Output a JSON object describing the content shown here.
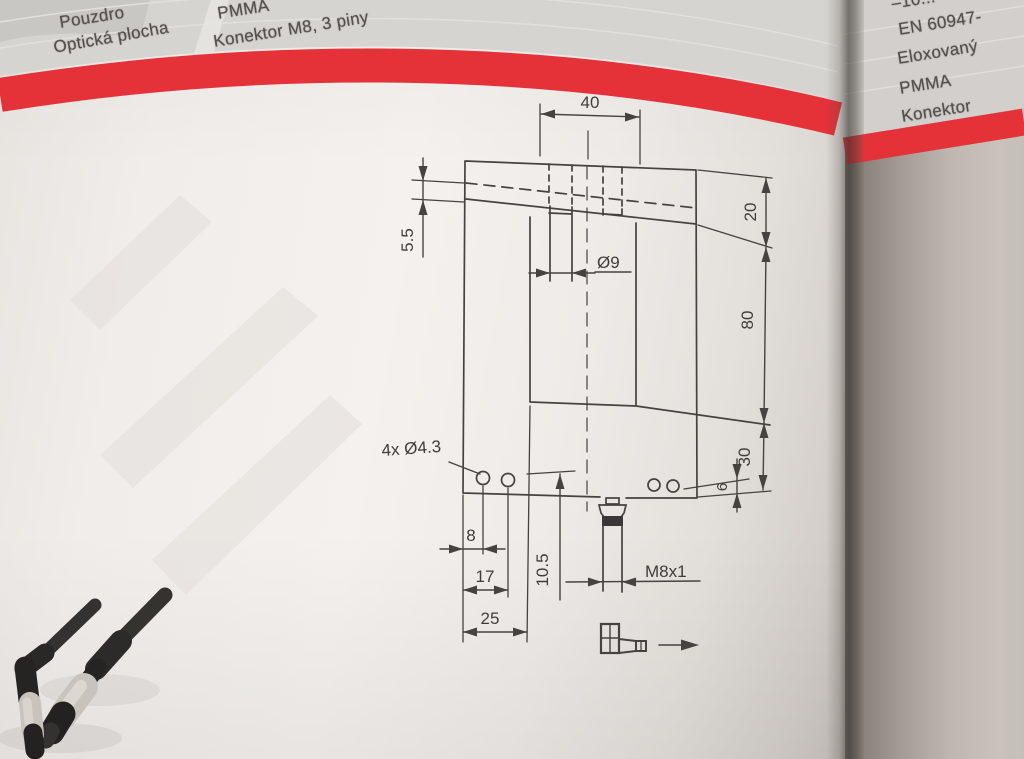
{
  "left_page": {
    "header": {
      "labels": [
        "Pouzdro",
        "Optická plocha"
      ],
      "values": [
        "PMMA",
        "Konektor M8, 3 piny"
      ]
    },
    "drawing": {
      "dims": {
        "top_width": "40",
        "depth": "20",
        "recess": "5.5",
        "hole_dia": "Ø9",
        "height": "80",
        "lower_height": "30",
        "edge_offset": "6",
        "mount_holes": "4x Ø4.3",
        "hole_spacing_1": "8",
        "hole_spacing_2": "17",
        "block_width": "25",
        "axis_offset": "10.5",
        "thread": "M8x1"
      }
    }
  },
  "right_page": {
    "header_rows": [
      "–10...",
      "EN 60947-",
      "Eloxovaný",
      "PMMA",
      "Konektor"
    ]
  },
  "colors": {
    "accent_red": "#e43238"
  }
}
